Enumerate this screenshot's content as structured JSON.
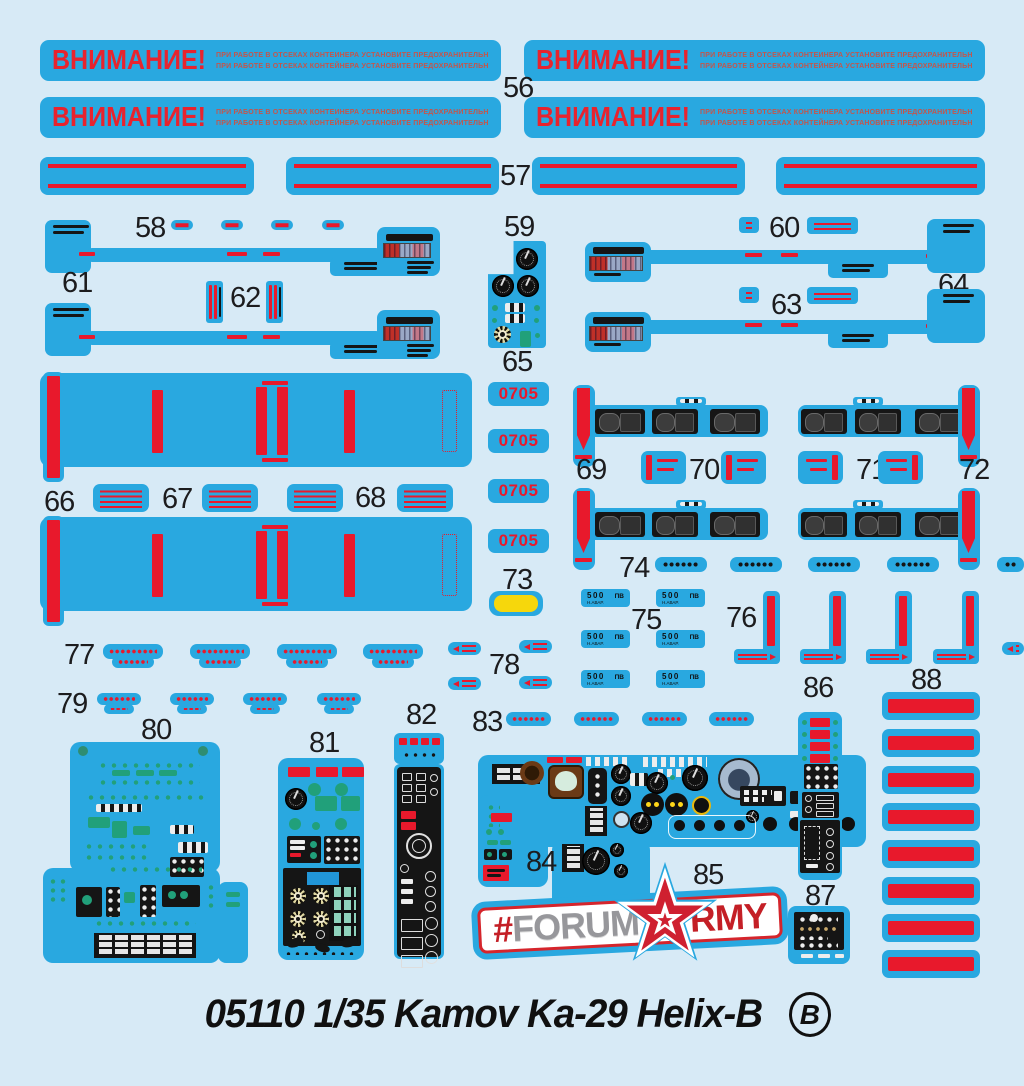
{
  "colors": {
    "background": "#d7eaf6",
    "decal_blue": "#29a8e0",
    "red": "#e8192c",
    "yellow": "#f6d70c",
    "teal": "#21a07a",
    "black": "#151515"
  },
  "warning": {
    "title": "ВНИМАНИЕ!",
    "line": "ПРИ РАБОТЕ В ОТСЕКАХ КОНТЕЙНЕРА УСТАНОВИТЕ ПРЕДОХРАНИТЕЛЬНЫЕ СКОБЫ"
  },
  "labels": {
    "56": "56",
    "57": "57",
    "58": "58",
    "59": "59",
    "60": "60",
    "61": "61",
    "62": "62",
    "63": "63",
    "64": "64",
    "65": "65",
    "66": "66",
    "67": "67",
    "68": "68",
    "69": "69",
    "70": "70",
    "71": "71",
    "72": "72",
    "73": "73",
    "74": "74",
    "75": "75",
    "76": "76",
    "77": "77",
    "78": "78",
    "79": "79",
    "80": "80",
    "81": "81",
    "82": "82",
    "83": "83",
    "84": "84",
    "85": "85",
    "86": "86",
    "87": "87",
    "88": "88"
  },
  "stencil": {
    "code": "0705",
    "speed": "500",
    "speed_sub": "Н.АВАР.",
    "speed_unit": "ПВ"
  },
  "logo": {
    "hash": "#",
    "forum": "FORUM",
    "army_suffix": "RMY",
    "star_icon": "star-icon"
  },
  "caption": {
    "title": "05110 1/35 Kamov Ka-29 Helix-B",
    "letter": "B"
  }
}
